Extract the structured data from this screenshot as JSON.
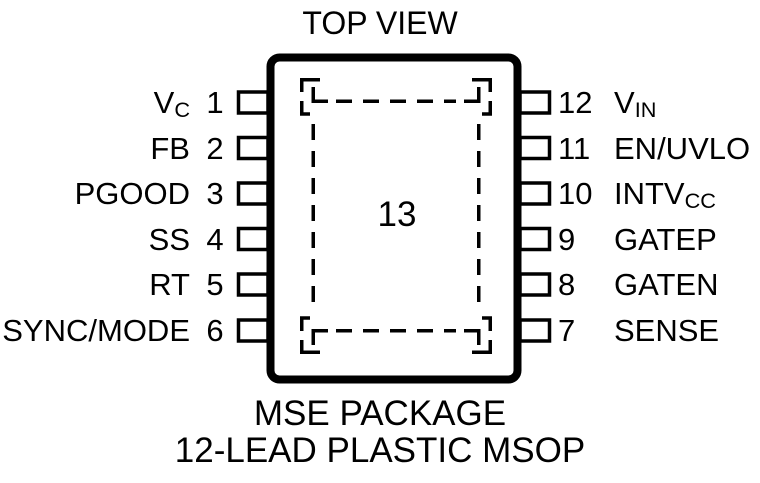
{
  "title": "TOP VIEW",
  "pad_label": "13",
  "captions": {
    "line1": "MSE PACKAGE",
    "line2": "12-LEAD PLASTIC MSOP"
  },
  "pins": {
    "left": [
      {
        "num": "1",
        "main": "V",
        "sub": "C"
      },
      {
        "num": "2",
        "main": "FB",
        "sub": ""
      },
      {
        "num": "3",
        "main": "PGOOD",
        "sub": ""
      },
      {
        "num": "4",
        "main": "SS",
        "sub": ""
      },
      {
        "num": "5",
        "main": "RT",
        "sub": ""
      },
      {
        "num": "6",
        "main": "SYNC/MODE",
        "sub": ""
      }
    ],
    "right": [
      {
        "num": "12",
        "main": "V",
        "sub": "IN"
      },
      {
        "num": "11",
        "main": "EN/UVLO",
        "sub": ""
      },
      {
        "num": "10",
        "main": "INTV",
        "sub": "CC"
      },
      {
        "num": "9",
        "main": "GATEP",
        "sub": ""
      },
      {
        "num": "8",
        "main": "GATEN",
        "sub": ""
      },
      {
        "num": "7",
        "main": "SENSE",
        "sub": ""
      }
    ]
  },
  "colors": {
    "ink": "#000000",
    "background": "#ffffff"
  }
}
